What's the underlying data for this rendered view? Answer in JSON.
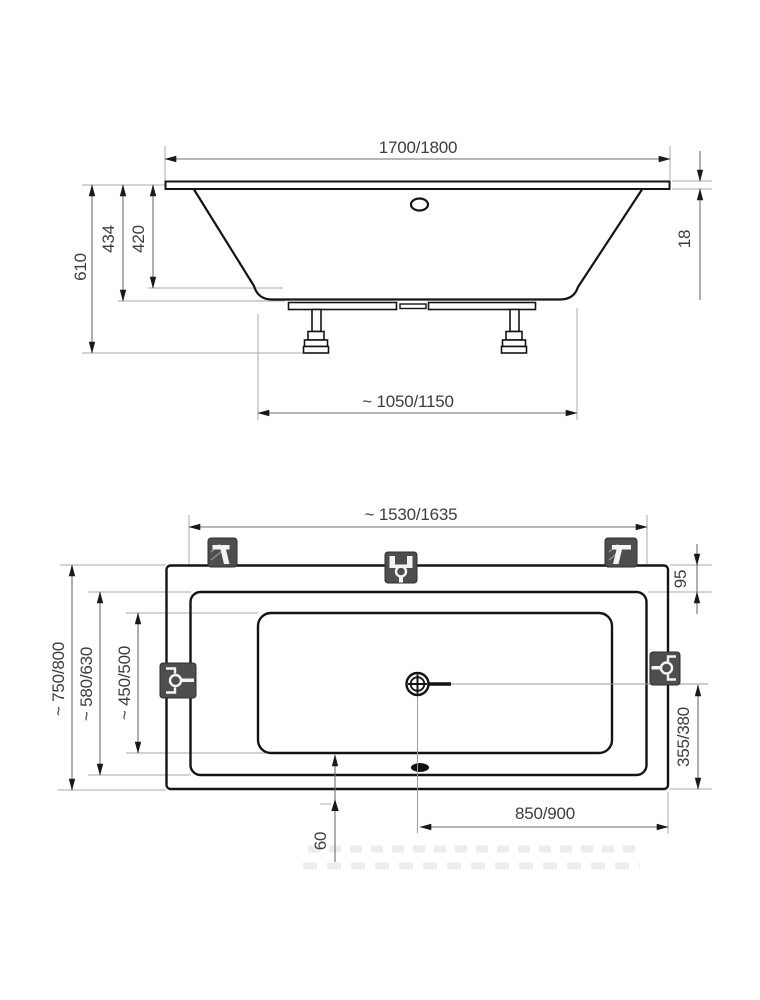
{
  "dimensions": {
    "elevation": {
      "top_width": "1700/1800",
      "rim_thickness": "18",
      "total_height": "610",
      "shell_height": "434",
      "inner_depth": "420",
      "base_width": "~ 1050/1150"
    },
    "plan": {
      "mount_width": "~ 1530/1635",
      "rim_offset": "95",
      "total_depth": "~ 750/800",
      "rim_depth": "~ 580/630",
      "basin_depth": "~ 450/500",
      "drain_to_bottom_edge": "355/380",
      "drain_to_right_edge": "850/900",
      "basin_bottom_offset": "60"
    }
  }
}
